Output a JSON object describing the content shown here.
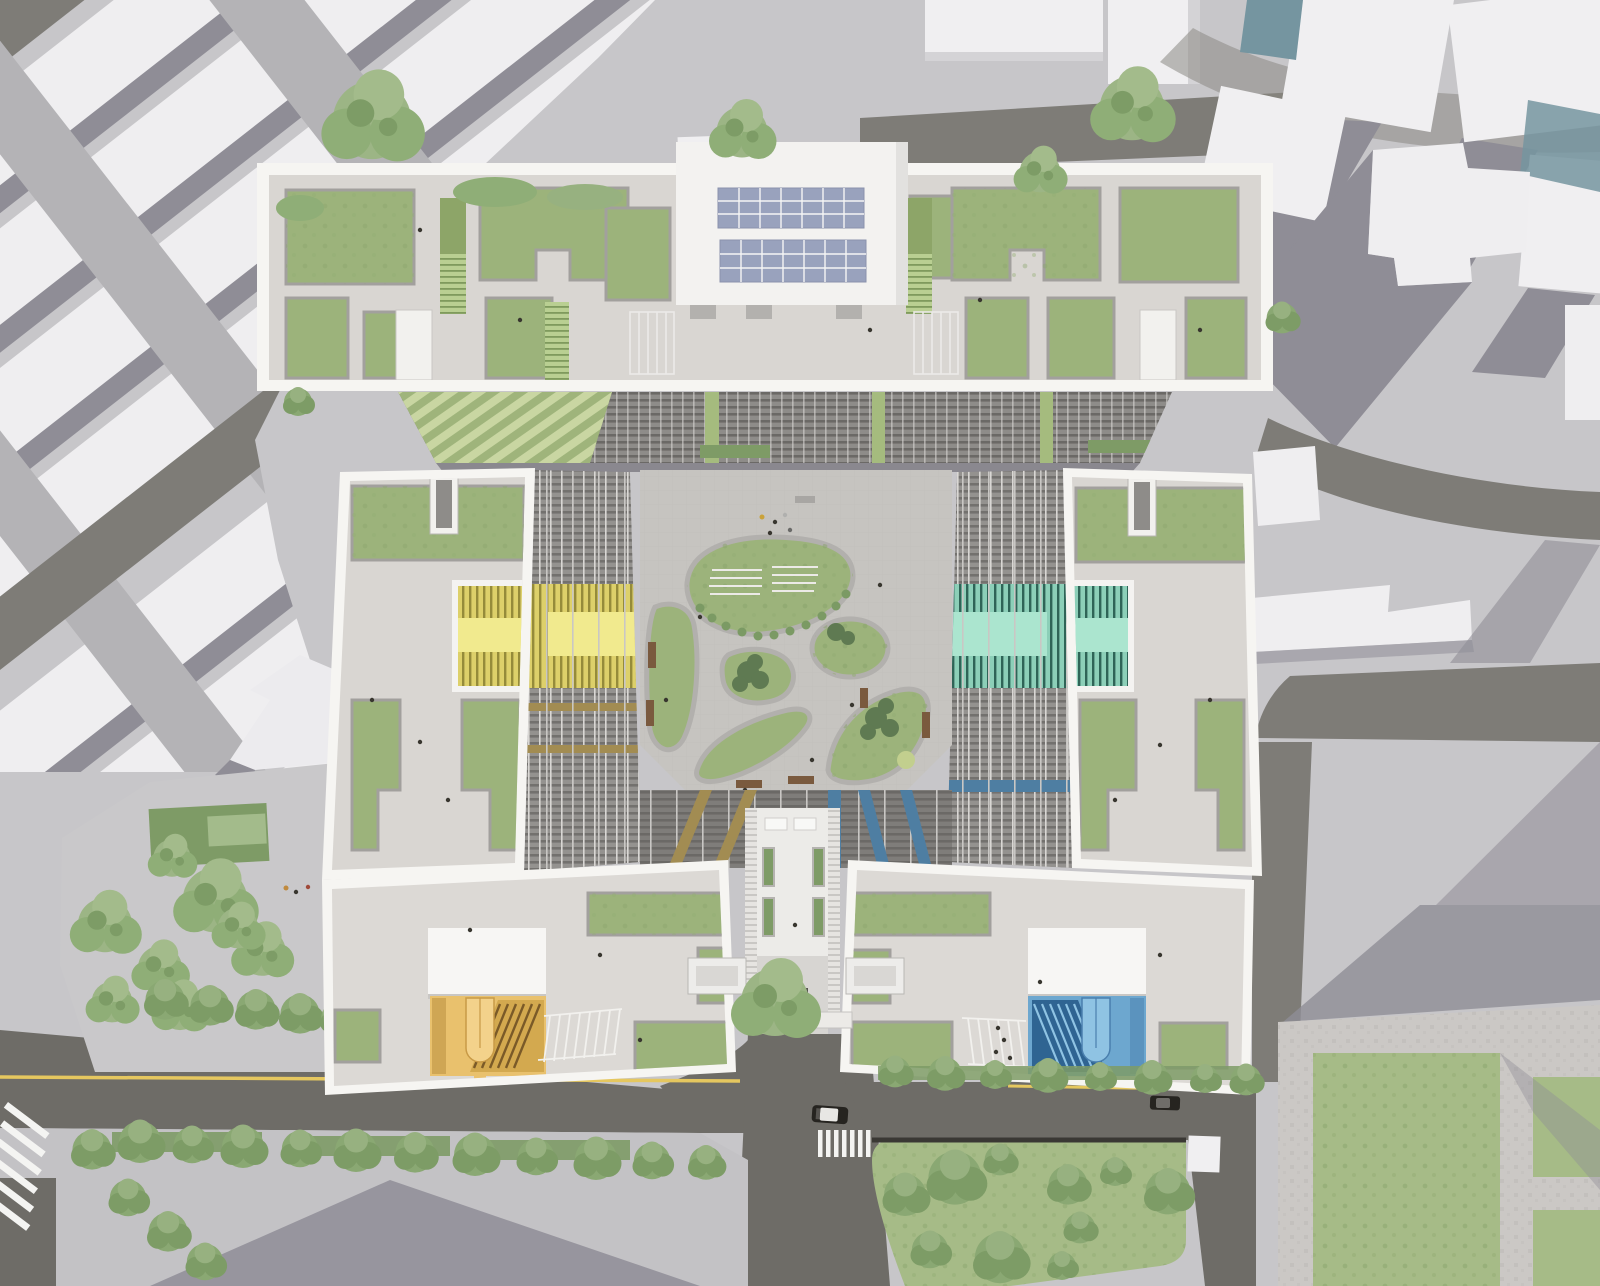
{
  "title": "Aerial architectural rendering — residential complex with central courtyard",
  "palette": {
    "ground": "#c7c6c9",
    "ground2": "#b4b3b6",
    "road": "#6e6c67",
    "road2": "#7e7c77",
    "sidewalk": "#c3c2c5",
    "shadow": "#8f8d96",
    "white_bldg": "#f0eff1",
    "frame": "#f6f5f2",
    "roof_pav": "#d9d6d2",
    "court_pav": "#c6c4c0",
    "grass": "#9cb37b",
    "lawn": "#a6bb87",
    "hedge": "#7e9b66",
    "tree": "#8fae77",
    "tree_dark": "#647f52",
    "parapet": "#a2a09d",
    "stair_green": "#b9cf92",
    "solar": "#99a2bd",
    "atrium_yellow": "#ddd06a",
    "atrium_yellow_bright": "#f1ea8e",
    "atrium_teal": "#8ccfb8",
    "atrium_teal_bright": "#abe5cf",
    "stair_amber": "#e9c16d",
    "stair_amber_light": "#f3d28b",
    "stair_blue": "#6da7cf",
    "stair_blue_light": "#8fc3e3",
    "stripe_gold": "#a28c52",
    "stripe_blue": "#4e7ea2",
    "louver_green": "#a5bb7e",
    "bench": "#7a5a3e",
    "yellow_line": "#e5c75f",
    "crosswalk": "#f4f4f2",
    "car_dark": "#262420",
    "glass_blue": "#7595a0"
  },
  "scene": {
    "context": {
      "nw_blocks": "diagonal white residential slabs",
      "ne_blocks": "white massing boxes with long shadows",
      "park": "pocket park with tree clusters",
      "roads": "asphalt streets with yellow center line"
    },
    "complex": {
      "north_slab": {
        "solar_arrays": 2,
        "solar_cols": 7,
        "solar_rows": 3,
        "roof": "green roof terraces with stairs and skylights"
      },
      "west_tower": {
        "atrium_color": "yellow"
      },
      "east_tower": {
        "atrium_color": "teal"
      },
      "southwest_wing": {
        "stair_color": "amber",
        "bike_racks": true
      },
      "southeast_wing": {
        "stair_color": "blue",
        "bike_racks": true
      },
      "courtyard": {
        "green_islands": 6,
        "amphitheater_bench_rows": 8
      }
    },
    "street": {
      "crosswalks": 2,
      "cars": 2
    }
  }
}
